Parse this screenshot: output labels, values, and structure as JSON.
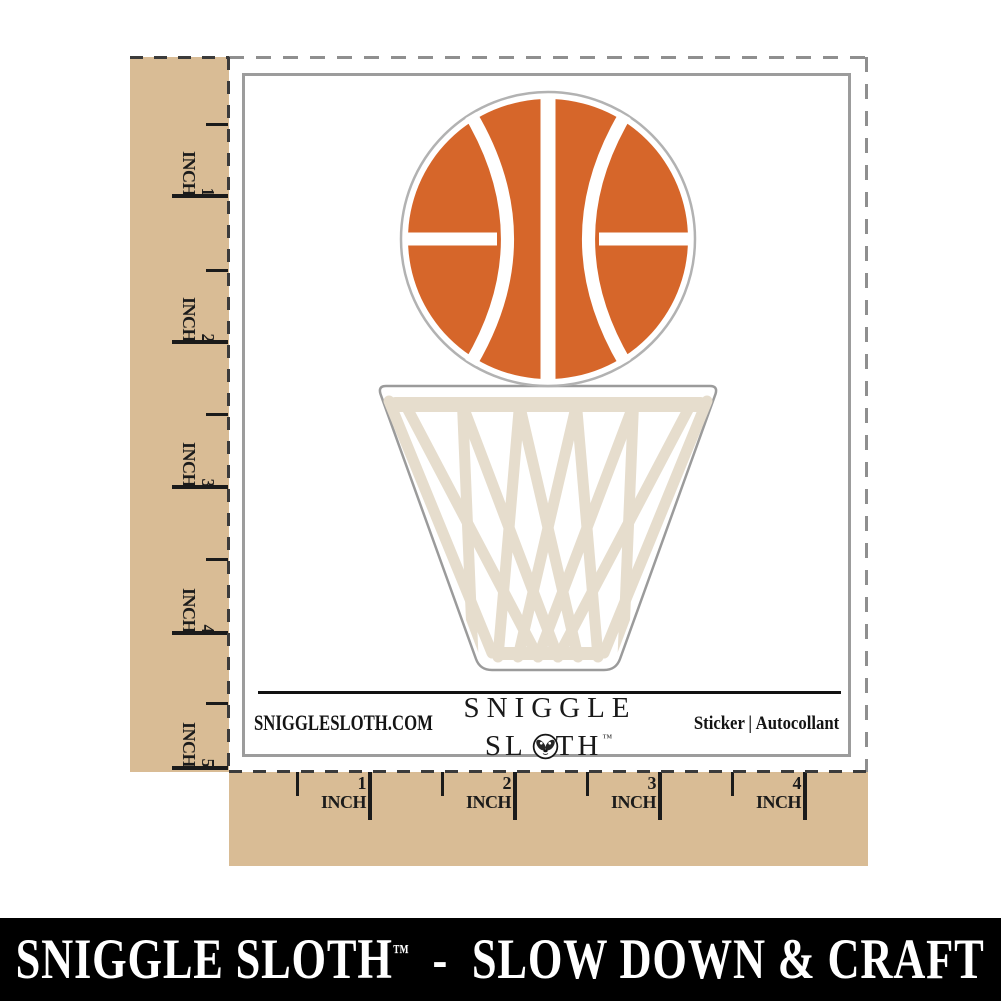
{
  "product": {
    "name": "basketball-over-hoop-die-cut-sticker",
    "elements": [
      "basketball-icon",
      "basketball-net-icon"
    ]
  },
  "rulers": {
    "unit": "INCH",
    "vertical_marks": [
      "1",
      "2",
      "3",
      "4",
      "5"
    ],
    "horizontal_marks": [
      "1",
      "2",
      "3",
      "4"
    ]
  },
  "sheet_footer": {
    "website": "SNIGGLESLOTH.COM",
    "brand_line1": "SNIGGLE",
    "brand_line2_prefix": "SL",
    "brand_line2_suffix": "TH",
    "brand_trademark": "™",
    "product_type": "Sticker",
    "product_type_separator": "|",
    "product_type_translation": "Autocollant"
  },
  "banner": {
    "brand": "SNIGGLE SLOTH",
    "trademark": "™",
    "tagline": "  -  SLOW DOWN & CRAFT"
  },
  "colors": {
    "ball_orange": "#d6662a",
    "net_cream": "#e6ddcd",
    "diecut_outline_gray": "#a8a8a8",
    "ruler_tan": "#d9bc95",
    "ink_black": "#1b1b1b",
    "sheet_border_gray": "#9c9c9c",
    "dash_gray": "#8f8f8f",
    "dash_dark": "#3b3b3b",
    "banner_bg": "#000000",
    "banner_text": "#ffffff"
  }
}
